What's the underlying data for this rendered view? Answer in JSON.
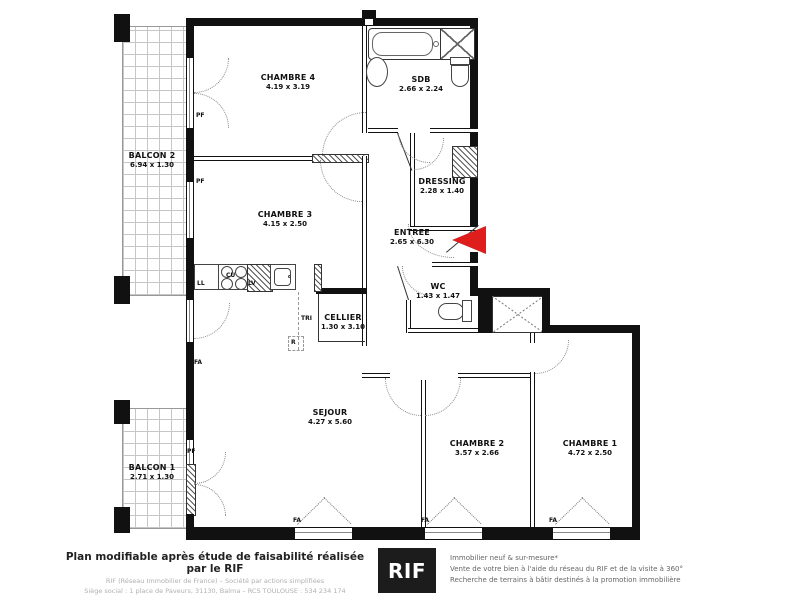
{
  "plan": {
    "rooms": {
      "chambre4": {
        "name": "CHAMBRE 4",
        "dims": "4.19 x 3.19"
      },
      "sdb": {
        "name": "SDB",
        "dims": "2.66 x 2.24"
      },
      "chambre3": {
        "name": "CHAMBRE 3",
        "dims": "4.15 x 2.50"
      },
      "dressing": {
        "name": "DRESSING",
        "dims": "2.28 x 1.40"
      },
      "entree": {
        "name": "ENTREE",
        "dims": "2.65 x 6.30"
      },
      "wc": {
        "name": "WC",
        "dims": "1.43 x 1.47"
      },
      "cellier": {
        "name": "CELLIER",
        "dims": "1.30 x 3.10"
      },
      "sejour": {
        "name": "SEJOUR",
        "dims": "4.27 x 5.60"
      },
      "chambre2": {
        "name": "CHAMBRE 2",
        "dims": "3.57 x 2.66"
      },
      "chambre1": {
        "name": "CHAMBRE 1",
        "dims": "4.72 x 2.50"
      },
      "balcon2": {
        "name": "BALCON 2",
        "dims": "6.94 x 1.30"
      },
      "balcon1": {
        "name": "BALCON 1",
        "dims": "2.71 x 1.30"
      }
    },
    "tags": {
      "pf": "PF",
      "fa": "FA",
      "ll": "LL",
      "cu": "CU",
      "lv": "LV",
      "tri": "TRI",
      "r": "R"
    },
    "entrance_arrow": {
      "direction": "left",
      "color": "#e01d1d"
    }
  },
  "footer": {
    "left": {
      "title": "Plan modifiable après étude de faisabilité réalisée par le RIF",
      "line2": "RIF (Réseau Immobilier de France) – Société par actions simplifiées",
      "line3": "Siège social : 1 place de Paveurs, 31130, Balma – RCS TOULOUSE : 534 234 174"
    },
    "logo": {
      "text": "RIF",
      "bg": "#1c1c1c"
    },
    "right": {
      "line1": "Immobilier neuf & sur-mesure*",
      "line2": "Vente de votre bien à l'aide du réseau du RIF et de la visite à 360°",
      "line3": "Recherche de terrains à bâtir destinés à la promotion immobilière"
    }
  }
}
